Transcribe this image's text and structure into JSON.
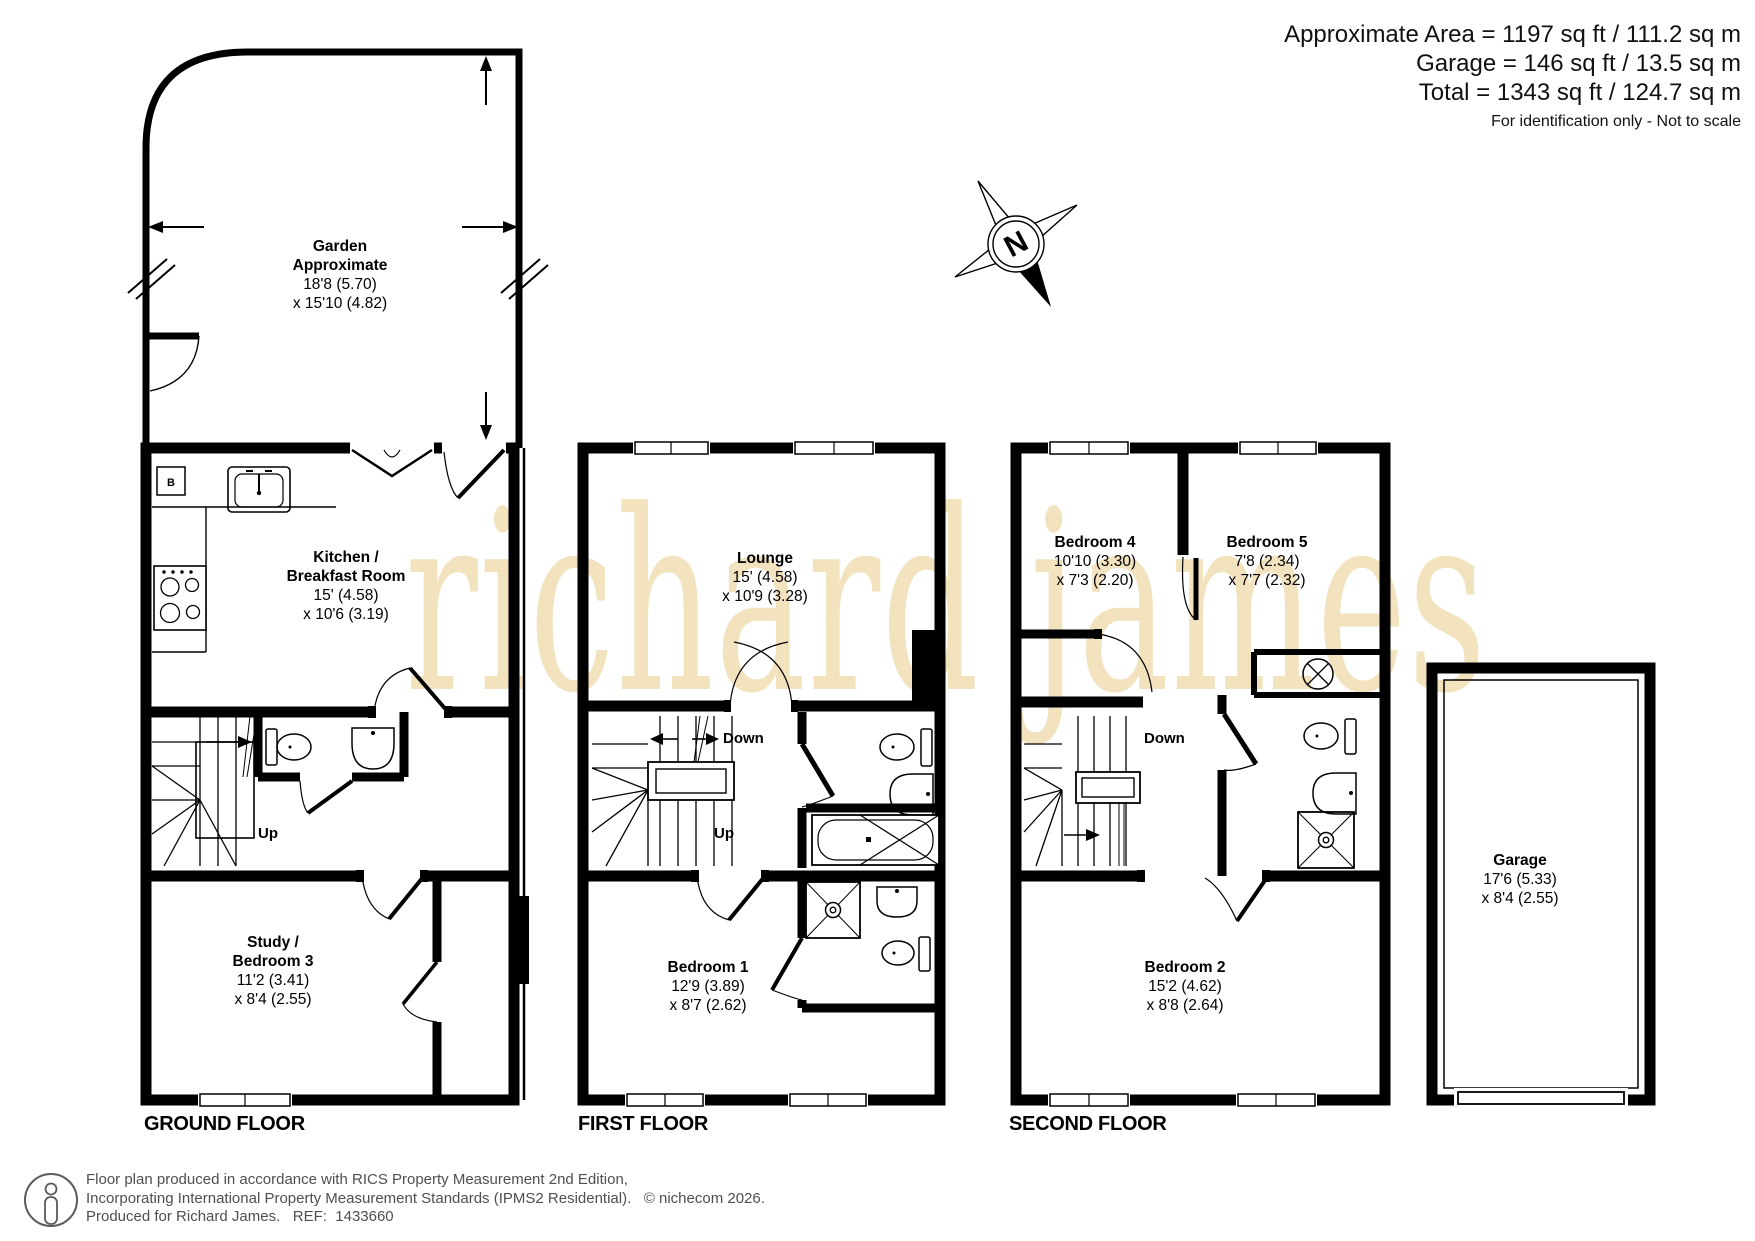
{
  "summary": {
    "approx": "Approximate Area = 1197 sq ft / 111.2 sq m",
    "garage": "Garage = 146 sq ft / 13.5 sq m",
    "total": "Total = 1343 sq ft / 124.7 sq m",
    "note": "For identification only - Not to scale"
  },
  "watermark": {
    "text": "richard james",
    "color": "#f0ddb2"
  },
  "compass": {
    "north": "N"
  },
  "colors": {
    "wall": "#000000",
    "footer_text": "#4f4f4f",
    "watermark": "#f0ddb2"
  },
  "rooms": {
    "garden": {
      "line1": "Garden",
      "line2": "Approximate",
      "dim1": "18'8 (5.70)",
      "dim2": "x 15'10 (4.82)"
    },
    "kitchen": {
      "line1": "Kitchen /",
      "line2": "Breakfast Room",
      "dim1": "15' (4.58)",
      "dim2": "x 10'6 (3.19)"
    },
    "study": {
      "line1": "Study /",
      "line2": "Bedroom 3",
      "dim1": "11'2 (3.41)",
      "dim2": "x 8'4 (2.55)"
    },
    "lounge": {
      "line1": "Lounge",
      "dim1": "15' (4.58)",
      "dim2": "x 10'9 (3.28)"
    },
    "bedroom1": {
      "line1": "Bedroom 1",
      "dim1": "12'9 (3.89)",
      "dim2": "x 8'7 (2.62)"
    },
    "bedroom4": {
      "line1": "Bedroom 4",
      "dim1": "10'10 (3.30)",
      "dim2": "x 7'3 (2.20)"
    },
    "bedroom5": {
      "line1": "Bedroom 5",
      "dim1": "7'8 (2.34)",
      "dim2": "x 7'7 (2.32)"
    },
    "bedroom2": {
      "line1": "Bedroom 2",
      "dim1": "15'2 (4.62)",
      "dim2": "x 8'8 (2.64)"
    },
    "garage": {
      "line1": "Garage",
      "dim1": "17'6 (5.33)",
      "dim2": "x 8'4 (2.55)"
    }
  },
  "stairs": {
    "up": "Up",
    "down": "Down"
  },
  "fixtures": {
    "boiler": "B"
  },
  "floor_titles": {
    "ground": "GROUND FLOOR",
    "first": "FIRST FLOOR",
    "second": "SECOND FLOOR"
  },
  "footer": {
    "line1": "Floor plan produced in accordance with RICS Property Measurement 2nd Edition,",
    "line2": "Incorporating International Property Measurement Standards (IPMS2 Residential).   © nichecom 2026.",
    "line3": "Produced for Richard James.   REF:  1433660"
  }
}
